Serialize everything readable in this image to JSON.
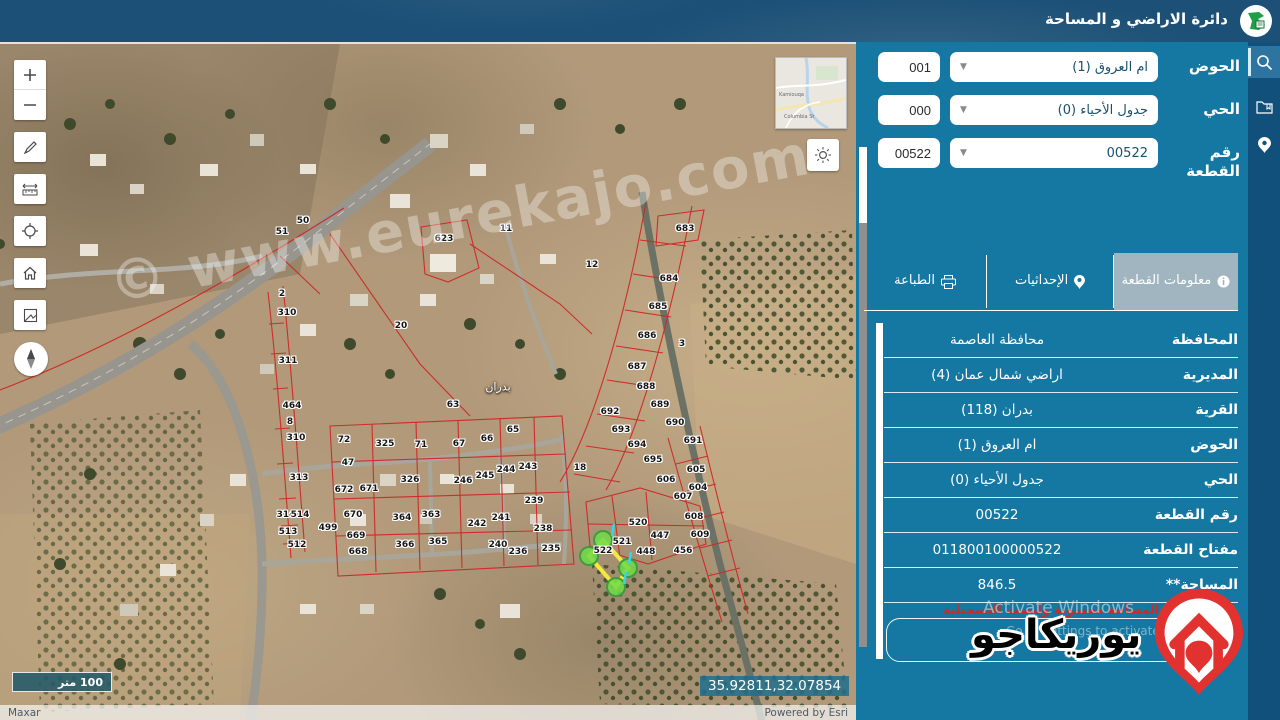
{
  "header": {
    "title": "دائرة الاراضي و المساحة"
  },
  "nav": {
    "items": [
      "search-icon",
      "files-icon",
      "location-icon"
    ]
  },
  "search_form": {
    "rows": [
      {
        "label": "الحوض",
        "select_value": "ام العروق (1)",
        "code": "001"
      },
      {
        "label": "الحي",
        "select_value": "جدول الأحياء (0)",
        "code": "000"
      },
      {
        "label": "رقم القطعة",
        "select_value": "00522",
        "code": "00522"
      }
    ]
  },
  "tabs": [
    {
      "label": "معلومات القطعة",
      "icon": "info-icon",
      "active": true
    },
    {
      "label": "الإحداثيات",
      "icon": "pin-icon",
      "active": false
    },
    {
      "label": "الطباعة",
      "icon": "printer-icon",
      "active": false
    }
  ],
  "parcel_info": {
    "rows": [
      {
        "label": "المحافظة",
        "value": "محافظة العاصمة"
      },
      {
        "label": "المديرية",
        "value": "اراضي شمال عمان (4)"
      },
      {
        "label": "القرية",
        "value": "بدران (118)"
      },
      {
        "label": "الحوض",
        "value": "ام العروق (1)"
      },
      {
        "label": "الحي",
        "value": "جدول الأحياء (0)"
      },
      {
        "label": "رقم القطعة",
        "value": "00522"
      },
      {
        "label": "مفتاح القطعة",
        "value": "011800100000522"
      },
      {
        "label": "المساحة**",
        "value": "846.5"
      }
    ],
    "note": "المساحة محسوبة وليست التسجيلية"
  },
  "watermarks": {
    "map": "© www.eurekajo.com",
    "brand_text": "يوريكاجو",
    "activate_line1": "Activate Windows",
    "activate_line2": "Go to Settings to activate Windows."
  },
  "map": {
    "scale_label": "100 متر",
    "coordinates": "35.92811,32.07854",
    "attribution_left": "Maxar",
    "attribution_right": "Powered by Esri",
    "place_label": "بدران",
    "inset_labels": [
      "Kamiouqa",
      "Columbia St"
    ],
    "toolbar": [
      "zoom-in",
      "zoom-out",
      "draw",
      "measure",
      "locate",
      "home",
      "basemap",
      "compass"
    ],
    "selected_parcel": "522",
    "parcel_labels": [
      [
        "50",
        303,
        177
      ],
      [
        "51",
        282,
        188
      ],
      [
        "623",
        444,
        195
      ],
      [
        "11",
        506,
        185
      ],
      [
        "12",
        592,
        221
      ],
      [
        "683",
        685,
        185
      ],
      [
        "684",
        669,
        235
      ],
      [
        "685",
        658,
        263
      ],
      [
        "686",
        647,
        292
      ],
      [
        "3",
        682,
        300
      ],
      [
        "2",
        282,
        250
      ],
      [
        "310",
        287,
        269
      ],
      [
        "20",
        401,
        282
      ],
      [
        "311",
        288,
        317
      ],
      [
        "464",
        292,
        362
      ],
      [
        "8",
        290,
        378
      ],
      [
        "310",
        296,
        394
      ],
      [
        "313",
        299,
        434
      ],
      [
        "314",
        286,
        471
      ],
      [
        "514",
        300,
        471
      ],
      [
        "513",
        288,
        488
      ],
      [
        "512",
        297,
        501
      ],
      [
        "499",
        328,
        484
      ],
      [
        "670",
        353,
        471
      ],
      [
        "669",
        356,
        492
      ],
      [
        "668",
        358,
        508
      ],
      [
        "672",
        344,
        446
      ],
      [
        "671",
        369,
        445
      ],
      [
        "47",
        348,
        419
      ],
      [
        "72",
        344,
        396
      ],
      [
        "325",
        385,
        400
      ],
      [
        "326",
        410,
        436
      ],
      [
        "364",
        402,
        474
      ],
      [
        "363",
        431,
        471
      ],
      [
        "366",
        405,
        501
      ],
      [
        "365",
        438,
        498
      ],
      [
        "71",
        421,
        401
      ],
      [
        "67",
        459,
        400
      ],
      [
        "66",
        487,
        395
      ],
      [
        "65",
        513,
        386
      ],
      [
        "63",
        453,
        361
      ],
      [
        "246",
        463,
        437
      ],
      [
        "245",
        485,
        432
      ],
      [
        "244",
        506,
        426
      ],
      [
        "243",
        528,
        423
      ],
      [
        "242",
        477,
        480
      ],
      [
        "241",
        501,
        474
      ],
      [
        "240",
        498,
        501
      ],
      [
        "239",
        534,
        457
      ],
      [
        "238",
        543,
        485
      ],
      [
        "236",
        518,
        508
      ],
      [
        "235",
        551,
        505
      ],
      [
        "18",
        580,
        424
      ],
      [
        "687",
        637,
        323
      ],
      [
        "688",
        646,
        343
      ],
      [
        "689",
        660,
        361
      ],
      [
        "690",
        675,
        379
      ],
      [
        "691",
        693,
        397
      ],
      [
        "692",
        610,
        368
      ],
      [
        "693",
        621,
        386
      ],
      [
        "694",
        637,
        401
      ],
      [
        "695",
        653,
        416
      ],
      [
        "605",
        696,
        426
      ],
      [
        "606",
        666,
        436
      ],
      [
        "604",
        698,
        444
      ],
      [
        "607",
        683,
        453
      ],
      [
        "608",
        694,
        473
      ],
      [
        "609",
        700,
        491
      ],
      [
        "520",
        638,
        479
      ],
      [
        "521",
        622,
        498
      ],
      [
        "522",
        603,
        507
      ],
      [
        "447",
        660,
        492
      ],
      [
        "448",
        646,
        508
      ],
      [
        "456",
        683,
        507
      ]
    ]
  }
}
